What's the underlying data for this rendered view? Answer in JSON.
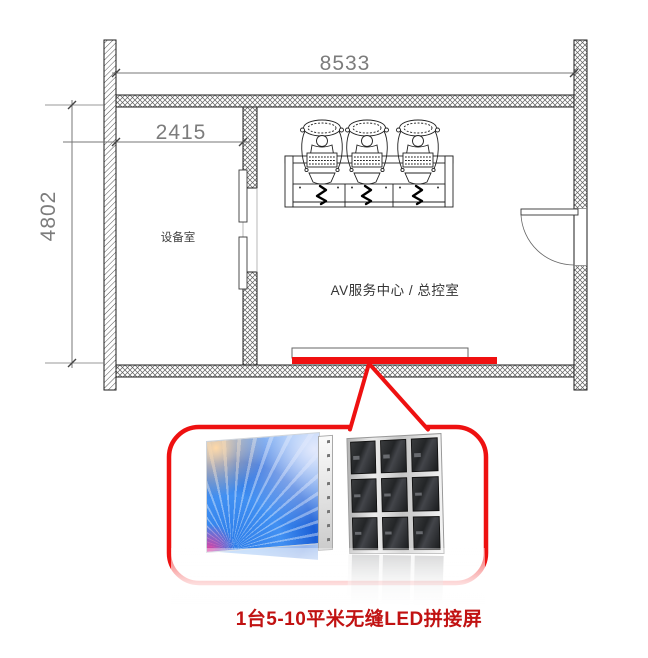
{
  "plan": {
    "dim_width": "8533",
    "dim_room": "2415",
    "dim_height": "4802",
    "equipment_room": "设备室",
    "control_room": "AV服务中心 / 总控室"
  },
  "callout": {
    "caption": "1台5-10平米无缝LED拼接屏"
  },
  "colors": {
    "led_red": "#f01010",
    "callout_red": "#ee1111",
    "caption_red": "#c11212",
    "dim_gray": "#7c7c7c"
  }
}
